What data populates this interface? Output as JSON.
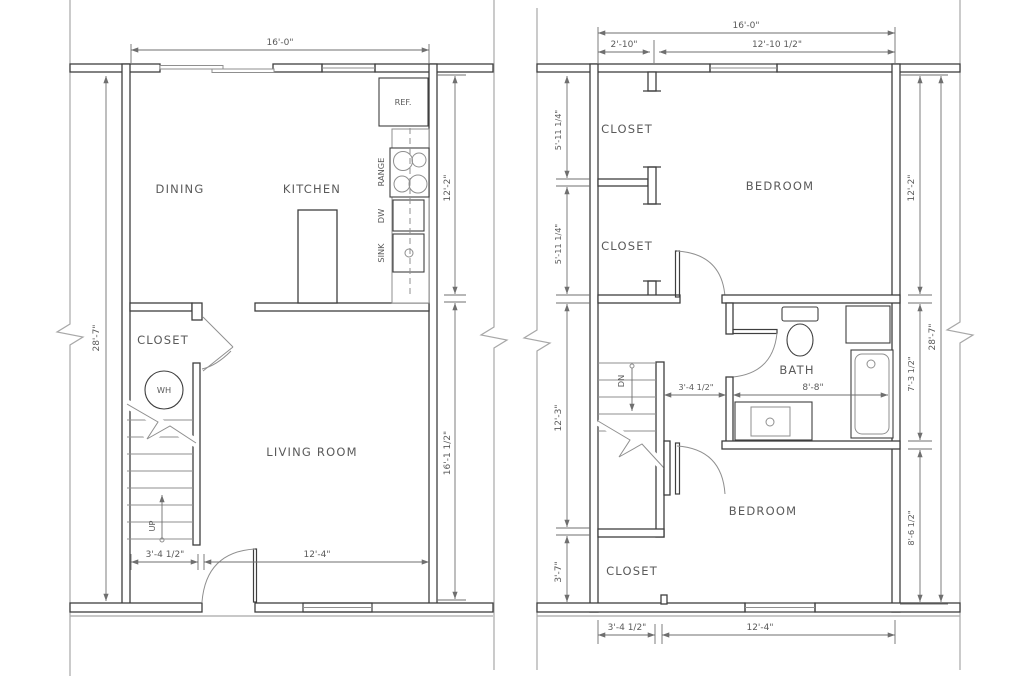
{
  "colors": {
    "wall": "#3f3f3f",
    "thin": "#8f8f8f",
    "dim": "#6f6f6f",
    "text": "#5a5a5a",
    "boundary": "#a8a8a8",
    "bg": "#ffffff"
  },
  "floor1": {
    "rooms": {
      "dining": "DINING",
      "kitchen": "KITCHEN",
      "closet": "CLOSET",
      "living": "LIVING ROOM"
    },
    "fixtures": {
      "ref": "REF.",
      "range": "RANGE",
      "dw": "DW",
      "sink": "SINK",
      "wh": "WH",
      "up": "UP"
    },
    "dims": {
      "top": "16'-0\"",
      "left": "28'-7\"",
      "right_upper": "12'-2\"",
      "right_lower": "16'-1 1/2\"",
      "bottom_left": "3'-4 1/2\"",
      "bottom_right": "12'-4\""
    }
  },
  "floor2": {
    "rooms": {
      "closet1": "CLOSET",
      "closet2": "CLOSET",
      "closet3": "CLOSET",
      "bedroom1": "BEDROOM",
      "bedroom2": "BEDROOM",
      "bath": "BATH"
    },
    "fixtures": {
      "dn": "DN"
    },
    "dims": {
      "top": "16'-0\"",
      "top_left": "2'-10\"",
      "top_right": "12'-10 1/2\"",
      "left1": "5'-11 1/4\"",
      "left2": "5'-11 1/4\"",
      "left3": "12'-3\"",
      "left4": "3'-7\"",
      "right1": "12'-2\"",
      "right2": "7'-3 1/2\"",
      "right3": "8'-6 1/2\"",
      "right_outer": "28'-7\"",
      "hall": "3'-4 1/2\"",
      "bath": "8'-8\"",
      "bottom_left": "3'-4 1/2\"",
      "bottom_right": "12'-4\""
    }
  }
}
